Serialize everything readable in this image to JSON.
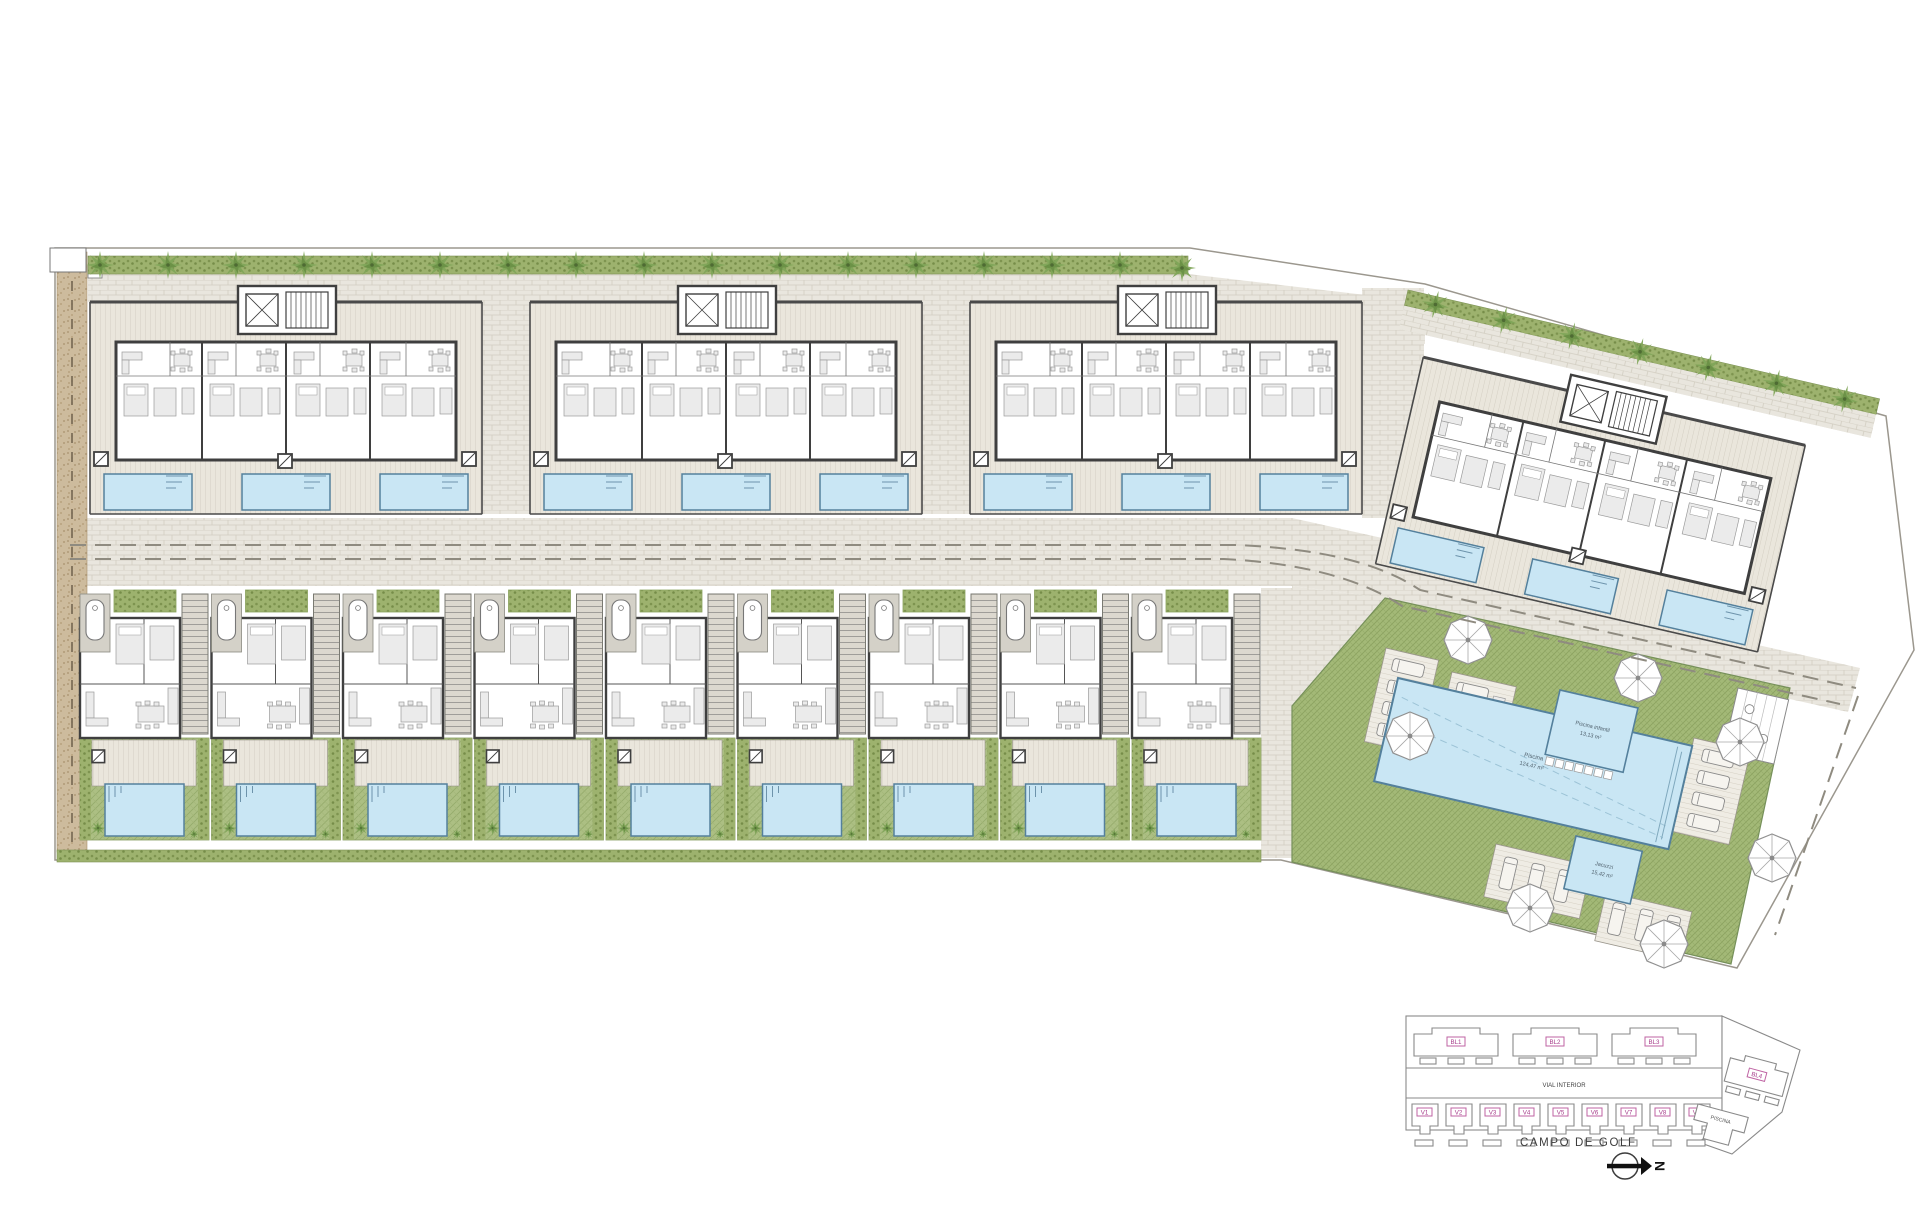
{
  "key_plan": {
    "blocks": [
      "BL1",
      "BL2",
      "BL3"
    ],
    "bl4": "BL4",
    "villas": [
      "V1",
      "V2",
      "V3",
      "V4",
      "V5",
      "V6",
      "V7",
      "V8",
      "V9"
    ],
    "road_label": "VIAL INTERIOR",
    "piscina_label": "PISCINA",
    "campo_label": "CAMPO DE GOLF",
    "north_label": "N"
  },
  "communal": {
    "main_pool_label": "Piscina",
    "main_pool_area": "124,47 m²",
    "kids_pool_label": "Piscina infantil",
    "kids_pool_area": "13,13 m²",
    "spa_pool_label": "Jacuzzi",
    "spa_pool_area": "15,42 m²"
  },
  "colors": {
    "pool": "#c9e6f4",
    "pool_edge": "#54809c",
    "grass": "#acbf83",
    "hedge": "#9db26e",
    "deck": "#eae6dc",
    "paving": "#e9e6de",
    "gravel": "#cdbb9d",
    "wall": "#3f3f3f",
    "label_pink": "#a73c8b",
    "tree_green": "#7fa558"
  }
}
